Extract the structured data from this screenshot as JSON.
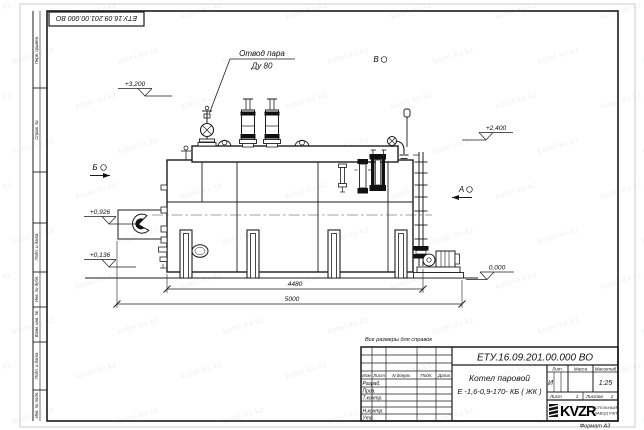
{
  "page": {
    "watermark": "kotel-kv.kz",
    "format_label": "Формат А3"
  },
  "top_stamp": {
    "doc_number": "ЕТУ.16.09.201.00.000  ВО"
  },
  "margin": {
    "labels": [
      "Перв. примен.",
      "Справ. №",
      "Подп. и дата",
      "Инв. № дубл.",
      "Взам. инв. №",
      "Подп. и дата",
      "Инв. № подл."
    ]
  },
  "drawing": {
    "callout": {
      "line1": "Отвод пара",
      "line2": "Ду 80"
    },
    "elevations": [
      "+3,200",
      "+2,400",
      "+0,926",
      "+0,136",
      "0,000"
    ],
    "sections": {
      "b": "Б",
      "v": "В",
      "a": "А"
    },
    "dimensions": [
      "4480",
      "5000"
    ],
    "note": "Все размеры для справок"
  },
  "title_block": {
    "doc_number": "ЕТУ.16.09.201.00.000  ВО",
    "product_name_line1": "Котел паровой",
    "product_name_line2": "Е -1,6-0,9-170- КБ ( ЖК )",
    "columns": {
      "izm": "Изм",
      "list": "Лист",
      "n_dokum": "N докум.",
      "podp": "Подп.",
      "data": "Дата"
    },
    "rows": [
      "Разраб.",
      "Пров.",
      "Т.контр.",
      "Н.контр.",
      "Утв."
    ],
    "lit_label": "Лит.",
    "massa_label": "Масса",
    "masshtab_label": "Масштаб",
    "lit_value": "И",
    "masshtab_value": "1:25",
    "list_label": "Лист",
    "list_value": "1",
    "listov_label": "Листов",
    "listov_value": "2",
    "logo_text": "KVZR",
    "company_line1": "КОТЕЛЬНЫЙ",
    "company_line2": "ЗАВОД РЭП"
  }
}
